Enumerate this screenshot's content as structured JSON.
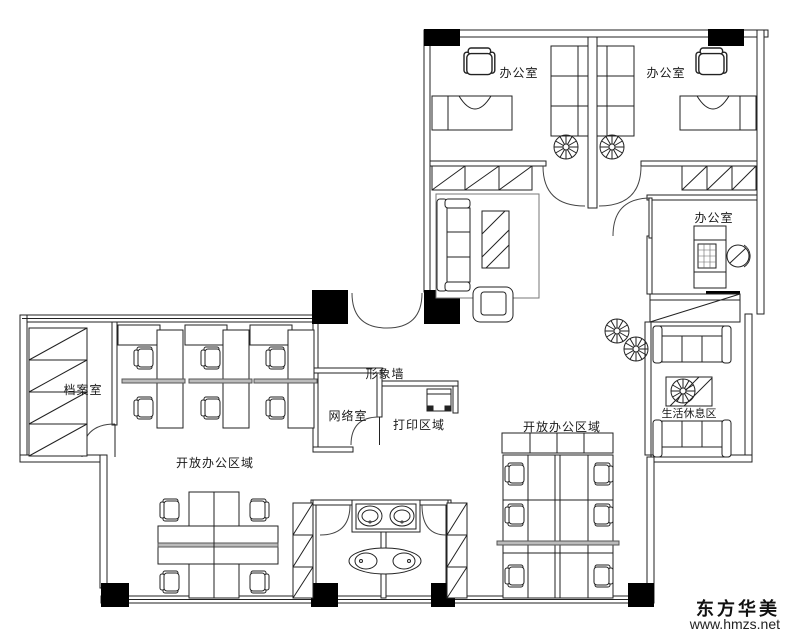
{
  "rooms": {
    "office_top_left": {
      "label": "办公室"
    },
    "office_top_right": {
      "label": "办公室"
    },
    "office_right": {
      "label": "办公室"
    },
    "archive_room": {
      "label": "档案室"
    },
    "feature_wall": {
      "label": "形象墙"
    },
    "network_room": {
      "label": "网络室"
    },
    "print_area": {
      "label": "打印区域"
    },
    "open_office_left": {
      "label": "开放办公区域"
    },
    "open_office_right": {
      "label": "开放办公区域"
    },
    "rest_area": {
      "label": "生活休息区"
    }
  },
  "watermark": {
    "brand": "东方华美",
    "url": "www.hmzs.net"
  },
  "colors": {
    "line": "#222222",
    "column": "#000000",
    "background": "#ffffff",
    "text": "#1a1a1a"
  }
}
